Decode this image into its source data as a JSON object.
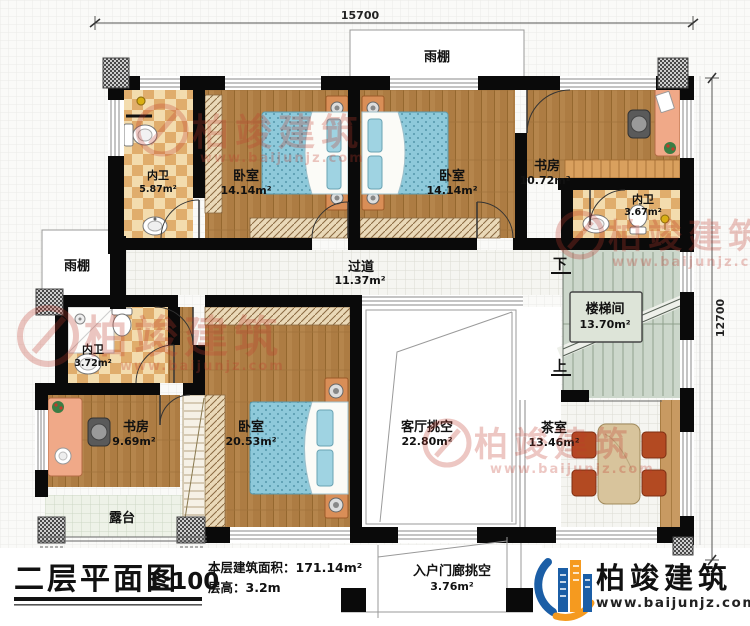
{
  "dimensions": {
    "top": "15700",
    "right": "12700"
  },
  "rooms": {
    "bath_top_left": {
      "name": "内卫",
      "area": "5.87m²"
    },
    "bedroom_top_left": {
      "name": "卧室",
      "area": "14.14m²"
    },
    "bedroom_top_mid": {
      "name": "卧室",
      "area": "14.14m²"
    },
    "study_top_right": {
      "name": "书房",
      "area": "10.72m²"
    },
    "bath_right": {
      "name": "内卫",
      "area": "3.67m²"
    },
    "corridor": {
      "name": "过道",
      "area": "11.37m²"
    },
    "stairwell": {
      "name": "楼梯间",
      "area": "13.70m²"
    },
    "bath_left": {
      "name": "内卫",
      "area": "3.72m²"
    },
    "study_bottom_left": {
      "name": "书房",
      "area": "9.69m²"
    },
    "bedroom_master": {
      "name": "卧室",
      "area": "20.53m²"
    },
    "living_void": {
      "name": "客厅挑空",
      "area": "22.80m²"
    },
    "tea_room": {
      "name": "茶室",
      "area": "13.46m²"
    },
    "terrace": {
      "name": "露台"
    },
    "entry_porch_void": {
      "name": "入户门廊挑空",
      "area": "3.76m²"
    },
    "canopy_top": {
      "name": "雨棚"
    },
    "canopy_left": {
      "name": "雨棚"
    }
  },
  "stairs": {
    "down_label": "下",
    "up_label": "上"
  },
  "title_block": {
    "title": "二层平面图",
    "scale": "1:100",
    "floor_area": "本层建筑面积：171.14m²",
    "floor_height": "层高：3.2m"
  },
  "brand": {
    "name": "柏竣建筑",
    "website": "www.baijunjz.com"
  },
  "watermark": {
    "text": "柏竣建筑",
    "url": "www.baijunjz.com"
  },
  "colors": {
    "wall": "#0a0a0a",
    "wood": "#b5854c",
    "watermark_red": "#c0392b",
    "brand_blue": "#1b5ea6",
    "brand_orange": "#f59a1f"
  }
}
